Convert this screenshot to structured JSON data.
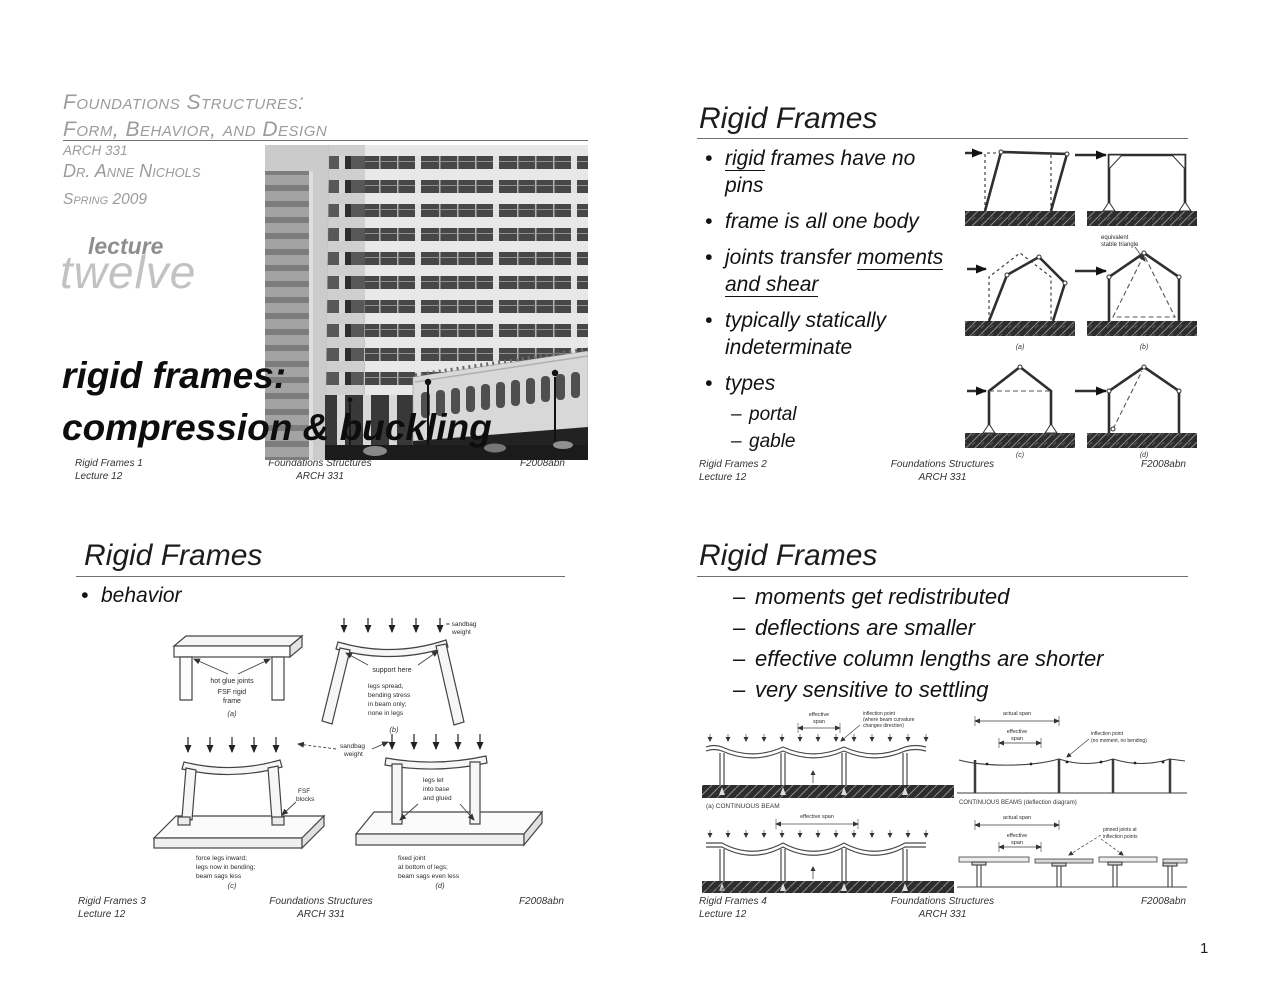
{
  "chars": {
    "bullet": "•",
    "dash": "–"
  },
  "page_number": "1",
  "slide1": {
    "course_line1": "Foundations Structures:",
    "course_line2": "Form, Behavior, and Design",
    "course_code": "ARCH 331",
    "instructor": "Dr. Anne Nichols",
    "term": "Spring 2009",
    "lecture_word": "lecture",
    "lecture_number": "twelve",
    "title_line1": "rigid frames:",
    "title_line2": "compression & buckling",
    "footer": {
      "left1": "Rigid Frames 1",
      "left2": "Lecture 12",
      "center1": "Foundations Structures",
      "center2": "ARCH 331",
      "right": "F2008abn"
    }
  },
  "slide2": {
    "title": "Rigid Frames",
    "bullets": {
      "b1_underlined": "rigid",
      "b1_rest": " frames have no pins",
      "b2": "frame is all one body",
      "b3_pre": "joints transfer ",
      "b3_underlined": "moments and shear",
      "b4": "typically statically indeterminate",
      "b5": "types",
      "sub1": "portal",
      "sub2": "gable"
    },
    "diagram": {
      "triangle_note_line1": "equivalent",
      "triangle_note_line2": "stable triangle",
      "label_a": "(a)",
      "label_b": "(b)",
      "label_c": "(c)",
      "label_d": "(d)"
    },
    "footer": {
      "left1": "Rigid Frames 2",
      "left2": "Lecture 12",
      "center1": "Foundations Structures",
      "center2": "ARCH 331",
      "right": "F2008abn"
    }
  },
  "slide3": {
    "title": "Rigid Frames",
    "bullet1": "behavior",
    "diagram": {
      "a": {
        "note": "hot glue joints",
        "name1": "FSF rigid",
        "name2": "frame",
        "label": "(a)"
      },
      "b": {
        "weight1": "= sandbag",
        "weight2": "weight",
        "support": "support here",
        "lines": [
          "legs spread,",
          "bending stress",
          "in beam only;",
          "none in legs"
        ],
        "label": "(b)"
      },
      "c": {
        "weight1": "sandbag",
        "weight2": "weight",
        "blocks1": "FSF",
        "blocks2": "blocks",
        "lines": [
          "force legs inward;",
          "legs now in bending;",
          "beam sags less"
        ],
        "label": "(c)"
      },
      "d": {
        "glue1": "legs let",
        "glue2": "into base",
        "glue3": "and glued",
        "lines": [
          "fixed joint",
          "at bottom of legs;",
          "beam sags even less"
        ],
        "label": "(d)"
      }
    },
    "footer": {
      "left1": "Rigid Frames 3",
      "left2": "Lecture 12",
      "center1": "Foundations Structures",
      "center2": "ARCH 331",
      "right": "F2008abn"
    }
  },
  "slide4": {
    "title": "Rigid Frames",
    "bullets": [
      "moments get redistributed",
      "deflections are smaller",
      "effective column lengths are shorter",
      "very sensitive to settling"
    ],
    "diagram_left": {
      "a": {
        "dim1": "effective",
        "dim2": "span",
        "note": [
          "inflection point",
          "(where beam curvature",
          "changes direction)"
        ],
        "caption": "(a) CONTINUOUS BEAM"
      },
      "b": {
        "dim": "effective span",
        "caption": "(b) SIMPLE BEAM"
      }
    },
    "diagram_right": {
      "top": {
        "actual": "actual span",
        "eff1": "effective",
        "eff2": "span",
        "note": [
          "inflection point",
          "(no moment, no bending)"
        ],
        "caption": "CONTINUOUS BEAMS (deflection diagram)"
      },
      "bottom": {
        "actual": "actual span",
        "eff1": "effective",
        "eff2": "span",
        "note": [
          "pinned joints at",
          "inflection points"
        ],
        "caption": "GERBER BEAMS"
      }
    },
    "footer": {
      "left1": "Rigid Frames 4",
      "left2": "Lecture 12",
      "center1": "Foundations Structures",
      "center2": "ARCH 331",
      "right": "F2008abn"
    }
  }
}
